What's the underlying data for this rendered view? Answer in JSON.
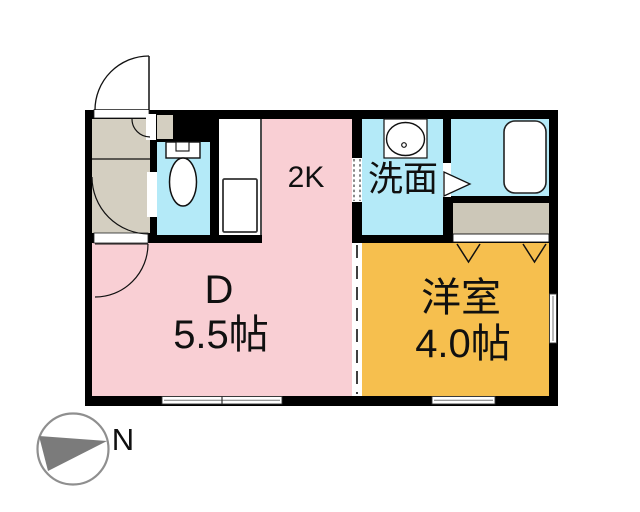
{
  "floorplan": {
    "layout_label": "2K",
    "rooms": {
      "dining": {
        "label": "D",
        "size": "5.5帖",
        "fill": "#f9cfd4"
      },
      "western": {
        "label": "洋室",
        "size": "4.0帖",
        "fill": "#f6bf4e"
      },
      "washroom": {
        "label": "洗面",
        "fill": "#b4eaf8"
      },
      "bath": {
        "fill": "#b4eaf8"
      },
      "toilet": {
        "fill": "#b4eaf8"
      },
      "entry": {
        "fill": "#d4cfc1"
      },
      "closet": {
        "fill": "#ccc7b8"
      }
    },
    "walls_fill": "#000000",
    "fixture_outline": "#111111",
    "icons": {
      "toilet": "toilet-icon",
      "sink": "sink-icon",
      "bathtub": "bathtub-icon",
      "compass_needle": "north-needle-icon"
    },
    "compass": {
      "label": "N",
      "ring_color": "#8f8f8f",
      "needle_color": "#7b7b7b",
      "label_color": "#909090"
    }
  }
}
